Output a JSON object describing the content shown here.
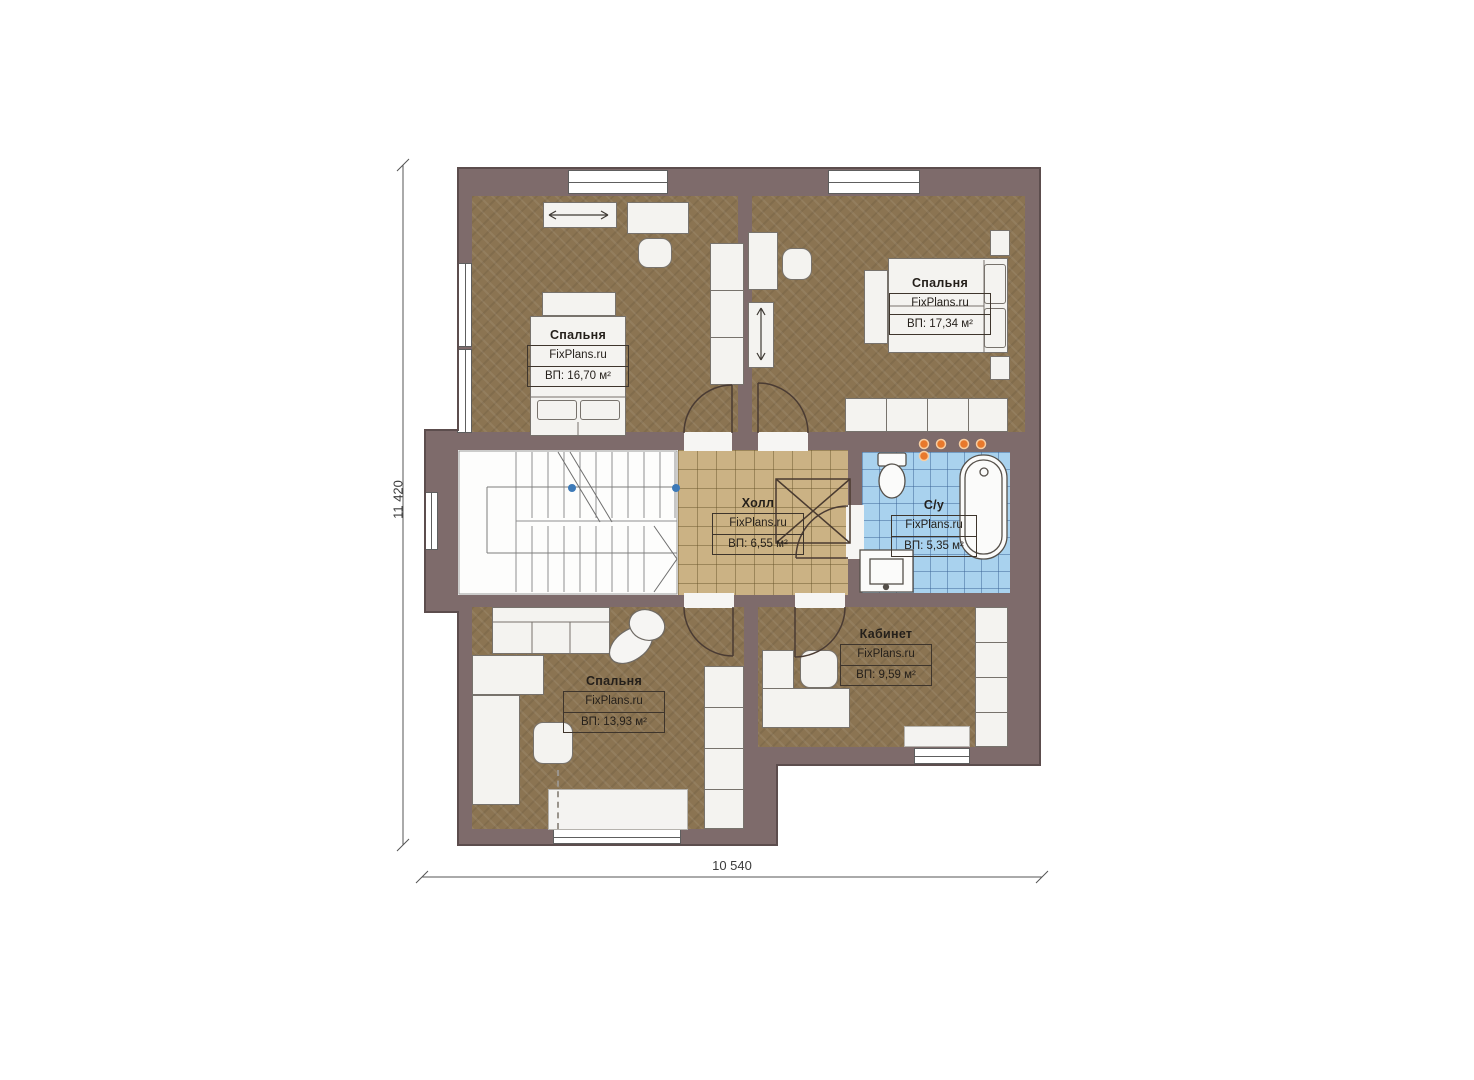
{
  "page": {
    "background": "#ffffff",
    "type": "floor-plan"
  },
  "branding": {
    "site": "FixPlans.ru"
  },
  "dimensions": {
    "vertical": "11 420",
    "horizontal": "10 540"
  },
  "rooms": {
    "bedroom_tl": {
      "name": "Спальня",
      "area": "ВП: 16,70 м²"
    },
    "bedroom_tr": {
      "name": "Спальня",
      "area": "ВП: 17,34 м²"
    },
    "hall": {
      "name": "Холл",
      "area": "ВП: 6,55 м²"
    },
    "bathroom": {
      "name": "С/у",
      "area": "ВП: 5,35 м²"
    },
    "office": {
      "name": "Кабинет",
      "area": "ВП: 9,59 м²"
    },
    "bedroom_bl": {
      "name": "Спальня",
      "area": "ВП: 13,93 м²"
    }
  },
  "colors": {
    "wall": "#7e6b6b",
    "carpet": "#8b7452",
    "tile_beige": "#cbb284",
    "tile_blue": "#a9d2ee",
    "fixture_white": "#f4f3f0",
    "light_orange": "#e8792c",
    "stair_dot_blue": "#3d7ab8"
  }
}
